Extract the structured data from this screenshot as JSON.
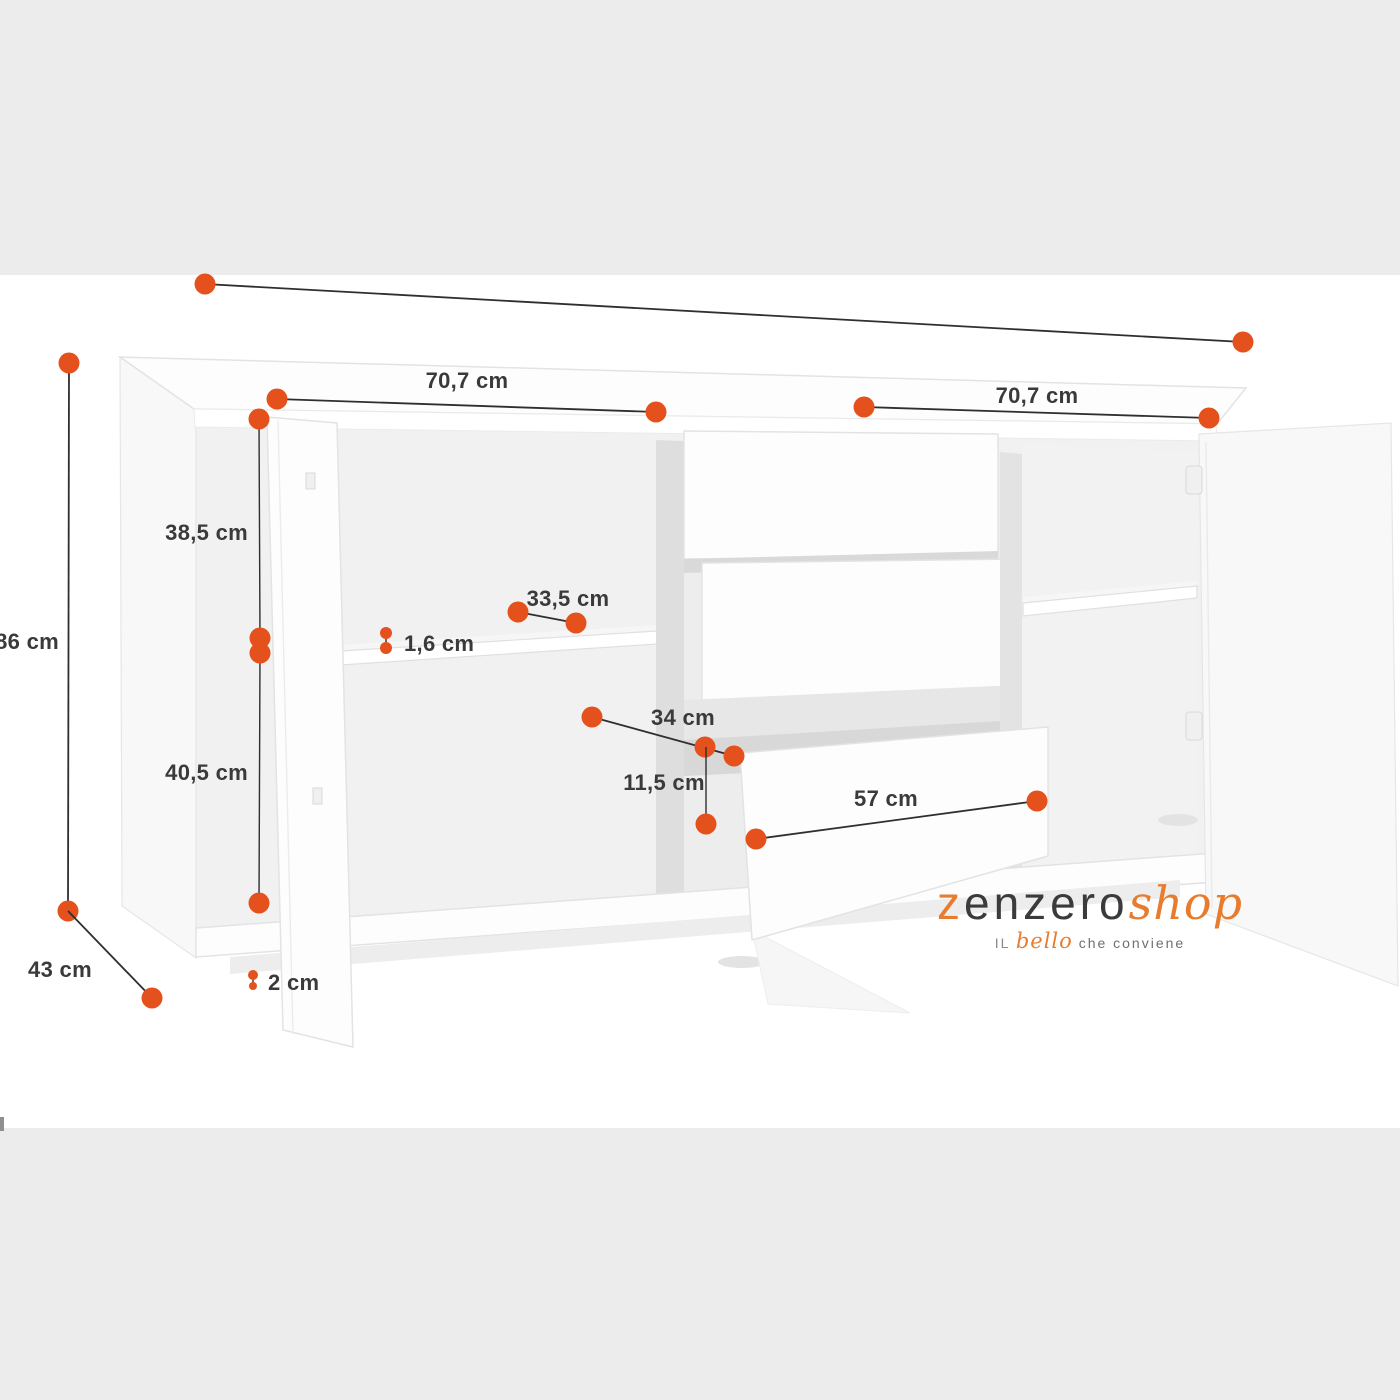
{
  "colors": {
    "accent_dot": "#e5511c",
    "brand_orange": "#e87c2e",
    "band_gray": "#ececec",
    "line_dark": "#2f2f2f",
    "label_gray": "#3a3a3a"
  },
  "labels": {
    "width_left": "70,7 cm",
    "width_right": "70,7 cm",
    "height_total": "86 cm",
    "depth_total": "43 cm",
    "upper_section_height": "38,5 cm",
    "lower_section_height": "40,5 cm",
    "shelf_thickness": "1,6 cm",
    "shelf_depth": "33,5 cm",
    "drawer_depth": "34 cm",
    "drawer_inner_height": "11,5 cm",
    "drawer_width": "57 cm",
    "plinth_height": "2 cm"
  },
  "logo": {
    "brand_start": "z",
    "brand_mid": "enzero",
    "brand_end": "shop",
    "tagline_start": "IL",
    "tagline_accent": "bello",
    "tagline_end": "che conviene"
  }
}
